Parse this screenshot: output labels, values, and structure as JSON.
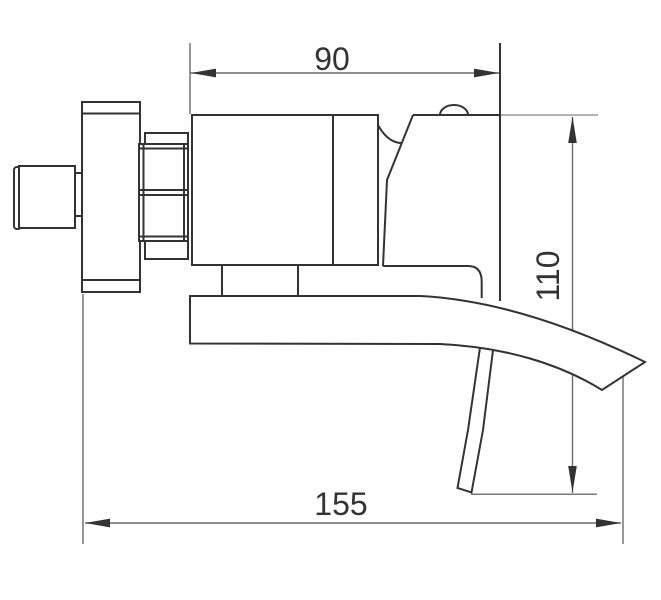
{
  "drawing": {
    "type": "technical-orthographic-side-view",
    "subject": "wall-mounted waterfall bathtub faucet",
    "colors": {
      "background": "#ffffff",
      "outline": "#333333",
      "dimension_lines": "#6b6b6b",
      "reference_line": "#9a9a9a"
    },
    "dimensions": {
      "top_width": {
        "value": "90"
      },
      "right_height": {
        "value": "110"
      },
      "bottom_width": {
        "value": "155"
      }
    }
  }
}
